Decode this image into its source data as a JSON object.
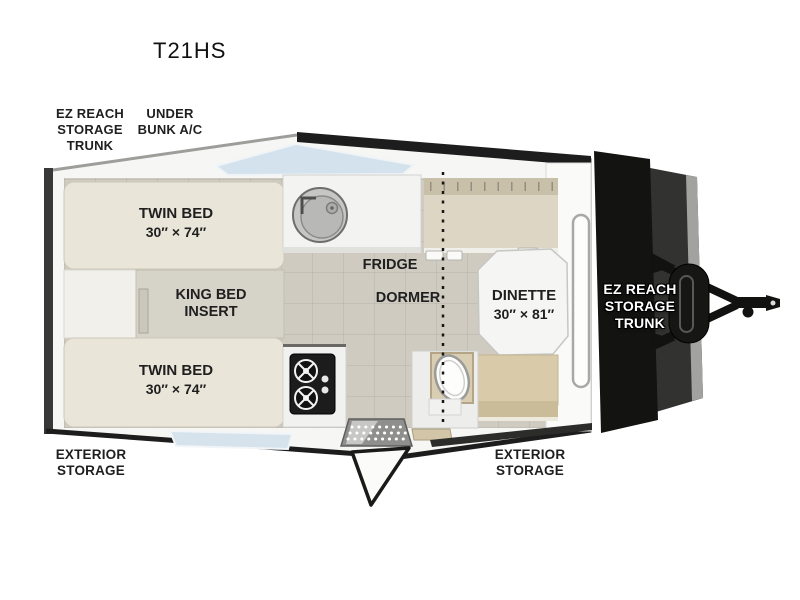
{
  "title": "T21HS",
  "callouts": {
    "roof_trunk": {
      "lines": [
        "EZ REACH",
        "STORAGE",
        "TRUNK"
      ]
    },
    "under_bunk_ac": {
      "lines": [
        "UNDER",
        "BUNK A/C"
      ]
    },
    "front_trunk": {
      "lines": [
        "EZ REACH",
        "STORAGE",
        "TRUNK"
      ]
    },
    "exterior_storage_left": {
      "lines": [
        "EXTERIOR",
        "STORAGE"
      ]
    },
    "exterior_storage_center": {
      "lines": [
        "EXTERIOR",
        "STORAGE"
      ]
    }
  },
  "features": {
    "twin_bed_top": {
      "name": "TWIN BED",
      "size": "30″ × 74″"
    },
    "king_bed_insert": {
      "lines": [
        "KING BED",
        "INSERT"
      ]
    },
    "twin_bed_bottom": {
      "name": "TWIN BED",
      "size": "30″ × 74″"
    },
    "fridge": {
      "name": "FRIDGE"
    },
    "dormer": {
      "name": "DORMER"
    },
    "dinette": {
      "name": "DINETTE",
      "size": "30″ × 81″"
    }
  },
  "colors": {
    "dark_trim": "#1d1d1d",
    "body_fill": "#f6f6f4",
    "floor": "#cfcbc1",
    "bed_cushion": "#eae5d9",
    "bench_tan": "#d9cba9",
    "bunk_tan": "#ded6c5",
    "cabinet_white": "#f3f3f1",
    "window_glass": "#d3e2ec",
    "label_text": "#1f1f1f"
  }
}
